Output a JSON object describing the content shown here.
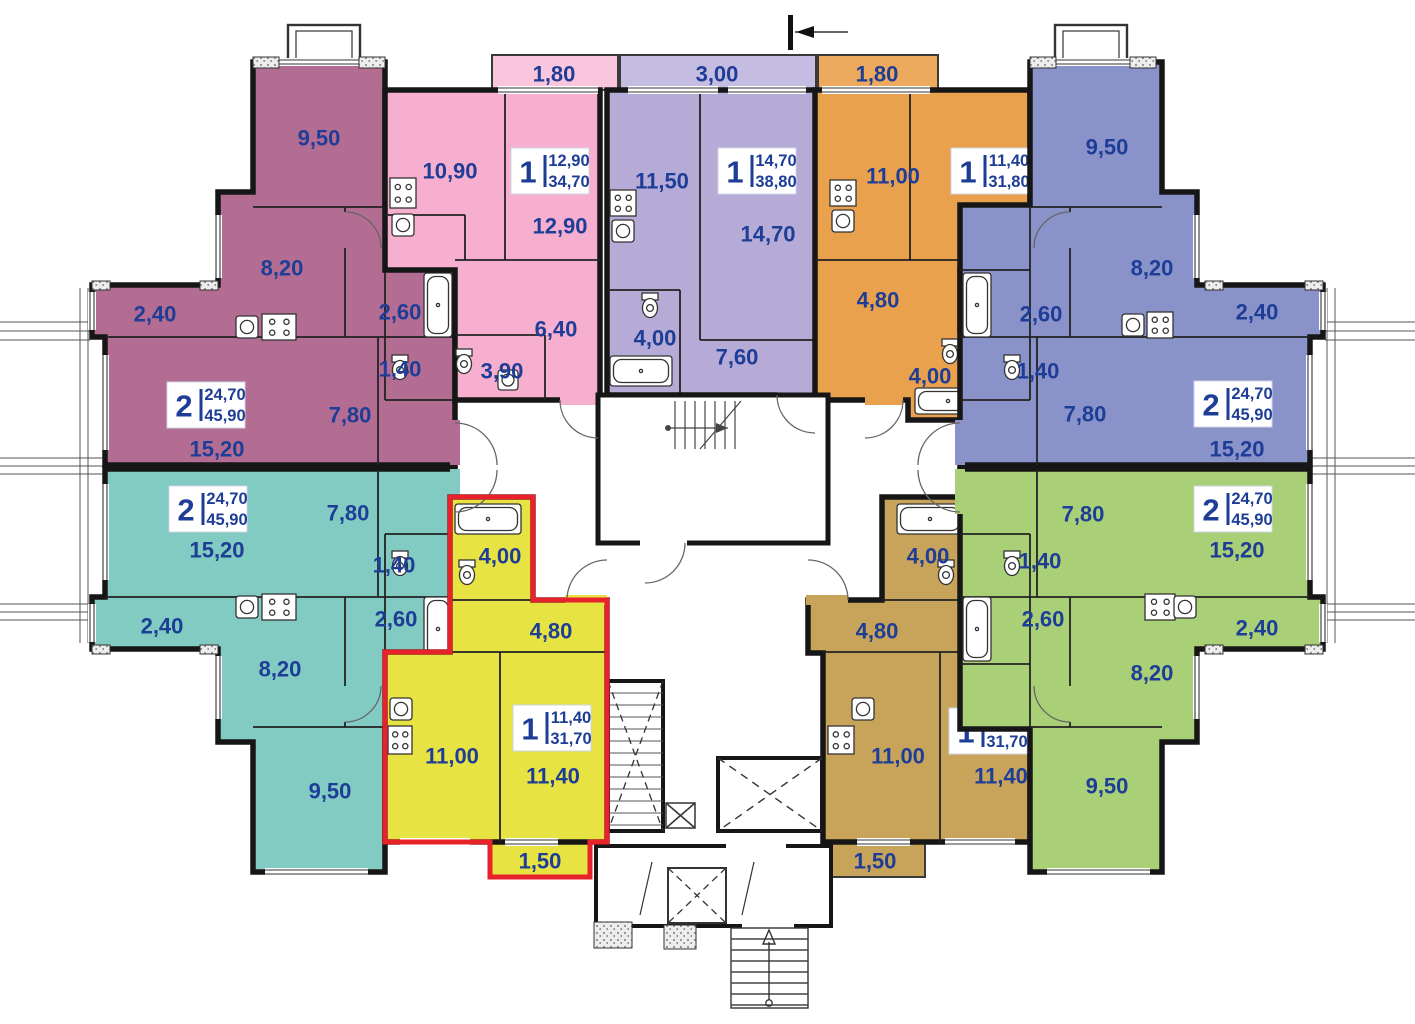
{
  "plan": {
    "kind": "residential-floor-plan",
    "selected_apartment": "yellow"
  },
  "colors": {
    "label_text": "#1e3d96",
    "selection_outline": "#e8222a",
    "walls": "#161616",
    "window_line": "#333333"
  },
  "icons": {
    "stove": "stove-icon",
    "sink": "sink-icon",
    "bathtub": "bathtub-icon",
    "toilet": "toilet-icon",
    "stairs": "stairs-icon",
    "elevator": "elevator-icon",
    "section_mark": "section-mark-icon",
    "entrance_arrow": "entrance-arrow-icon"
  },
  "apartments": [
    {
      "id": "maroon",
      "color": "#b36d92",
      "selected": false,
      "info": {
        "rooms": "2",
        "living": "24,70",
        "total": "45,90",
        "x": 206,
        "y": 405
      },
      "rooms": [
        {
          "area": "9,50",
          "x": 319,
          "y": 138
        },
        {
          "area": "8,20",
          "x": 282,
          "y": 268
        },
        {
          "area": "2,40",
          "x": 155,
          "y": 314
        },
        {
          "area": "15,20",
          "x": 217,
          "y": 449
        },
        {
          "area": "7,80",
          "x": 350,
          "y": 415
        },
        {
          "area": "2,60",
          "x": 400,
          "y": 312
        },
        {
          "area": "1,40",
          "x": 400,
          "y": 369
        }
      ]
    },
    {
      "id": "pink",
      "color": "#f7afd0",
      "selected": false,
      "info": {
        "rooms": "1",
        "living": "12,90",
        "total": "34,70",
        "x": 550,
        "y": 171
      },
      "balcony": {
        "area": "1,80",
        "x": 554,
        "y": 74
      },
      "rooms": [
        {
          "area": "10,90",
          "x": 450,
          "y": 171
        },
        {
          "area": "12,90",
          "x": 560,
          "y": 226
        },
        {
          "area": "6,40",
          "x": 556,
          "y": 329
        },
        {
          "area": "3,90",
          "x": 502,
          "y": 371
        }
      ]
    },
    {
      "id": "lavender",
      "color": "#b6abd7",
      "selected": false,
      "info": {
        "rooms": "1",
        "living": "14,70",
        "total": "38,80",
        "x": 757,
        "y": 171
      },
      "balcony": {
        "area": "3,00",
        "x": 717,
        "y": 74
      },
      "rooms": [
        {
          "area": "11,50",
          "x": 662,
          "y": 181
        },
        {
          "area": "14,70",
          "x": 768,
          "y": 234
        },
        {
          "area": "4,00",
          "x": 655,
          "y": 338
        },
        {
          "area": "7,60",
          "x": 737,
          "y": 357
        }
      ]
    },
    {
      "id": "orange",
      "color": "#e9a14e",
      "selected": false,
      "info": {
        "rooms": "1",
        "living": "11,40",
        "total": "31,80",
        "x": 990,
        "y": 171
      },
      "balcony": {
        "area": "1,80",
        "x": 877,
        "y": 74
      },
      "rooms": [
        {
          "area": "11,00",
          "x": 893,
          "y": 176
        },
        {
          "area": "11,40",
          "x": 998,
          "y": 220
        },
        {
          "area": "4,80",
          "x": 878,
          "y": 300
        },
        {
          "area": "4,00",
          "x": 930,
          "y": 376
        }
      ]
    },
    {
      "id": "blue",
      "color": "#8a92ca",
      "selected": false,
      "info": {
        "rooms": "2",
        "living": "24,70",
        "total": "45,90",
        "x": 1233,
        "y": 404
      },
      "rooms": [
        {
          "area": "9,50",
          "x": 1107,
          "y": 147
        },
        {
          "area": "8,20",
          "x": 1152,
          "y": 268
        },
        {
          "area": "2,40",
          "x": 1257,
          "y": 312
        },
        {
          "area": "7,80",
          "x": 1085,
          "y": 414
        },
        {
          "area": "15,20",
          "x": 1237,
          "y": 449
        },
        {
          "area": "2,60",
          "x": 1041,
          "y": 314
        },
        {
          "area": "1,40",
          "x": 1038,
          "y": 371
        }
      ]
    },
    {
      "id": "teal",
      "color": "#82cbc2",
      "selected": false,
      "info": {
        "rooms": "2",
        "living": "24,70",
        "total": "45,90",
        "x": 208,
        "y": 509
      },
      "rooms": [
        {
          "area": "15,20",
          "x": 217,
          "y": 550
        },
        {
          "area": "7,80",
          "x": 348,
          "y": 513
        },
        {
          "area": "2,40",
          "x": 162,
          "y": 626
        },
        {
          "area": "8,20",
          "x": 280,
          "y": 669
        },
        {
          "area": "9,50",
          "x": 330,
          "y": 791
        },
        {
          "area": "2,60",
          "x": 396,
          "y": 619
        },
        {
          "area": "1,40",
          "x": 394,
          "y": 565
        }
      ]
    },
    {
      "id": "yellow",
      "color": "#e7e343",
      "selected": true,
      "info": {
        "rooms": "1",
        "living": "11,40",
        "total": "31,70",
        "x": 552,
        "y": 728
      },
      "balcony": {
        "area": "1,50",
        "x": 540,
        "y": 861
      },
      "rooms": [
        {
          "area": "4,00",
          "x": 500,
          "y": 556
        },
        {
          "area": "4,80",
          "x": 551,
          "y": 631
        },
        {
          "area": "11,00",
          "x": 452,
          "y": 756
        },
        {
          "area": "11,40",
          "x": 553,
          "y": 776
        }
      ]
    },
    {
      "id": "tan",
      "color": "#c8a45b",
      "selected": false,
      "info": {
        "rooms": "1",
        "living": "11,40",
        "total": "31,70",
        "x": 988,
        "y": 731
      },
      "balcony": {
        "area": "1,50",
        "x": 875,
        "y": 861
      },
      "rooms": [
        {
          "area": "4,00",
          "x": 928,
          "y": 556
        },
        {
          "area": "4,80",
          "x": 877,
          "y": 631
        },
        {
          "area": "11,00",
          "x": 898,
          "y": 756
        },
        {
          "area": "11,40",
          "x": 1001,
          "y": 776
        }
      ]
    },
    {
      "id": "green",
      "color": "#a9cf77",
      "selected": false,
      "info": {
        "rooms": "2",
        "living": "24,70",
        "total": "45,90",
        "x": 1233,
        "y": 509
      },
      "rooms": [
        {
          "area": "7,80",
          "x": 1083,
          "y": 514
        },
        {
          "area": "15,20",
          "x": 1237,
          "y": 550
        },
        {
          "area": "2,40",
          "x": 1257,
          "y": 628
        },
        {
          "area": "8,20",
          "x": 1152,
          "y": 673
        },
        {
          "area": "9,50",
          "x": 1107,
          "y": 786
        },
        {
          "area": "2,60",
          "x": 1043,
          "y": 619
        },
        {
          "area": "1,40",
          "x": 1040,
          "y": 561
        }
      ]
    }
  ]
}
